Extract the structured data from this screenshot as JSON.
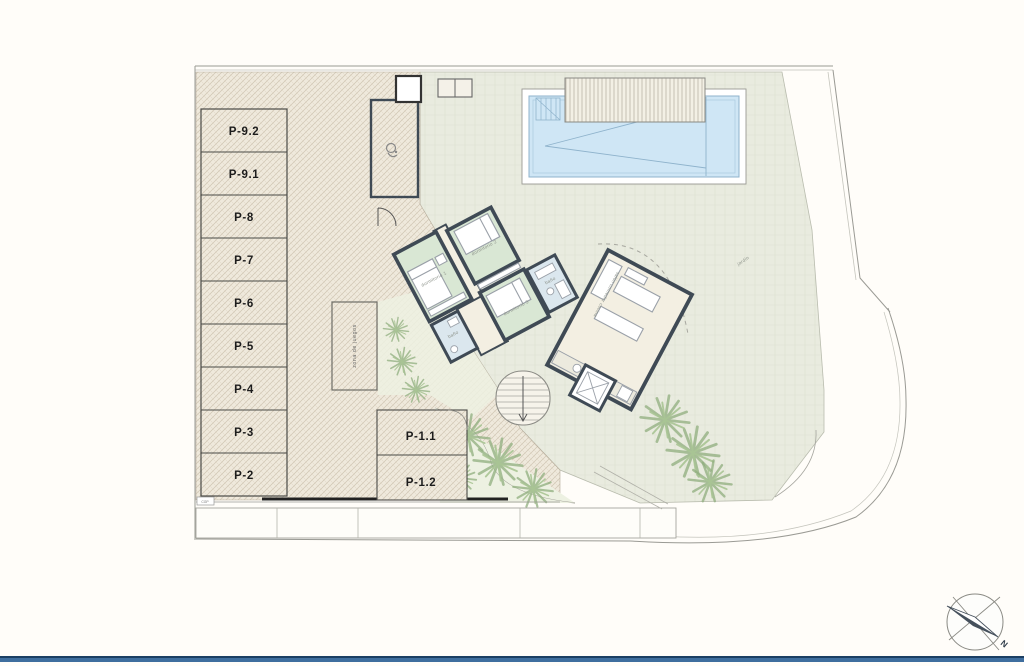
{
  "parking": {
    "stalls": [
      {
        "label": "P-9.2"
      },
      {
        "label": "P-9.1"
      },
      {
        "label": "P-8"
      },
      {
        "label": "P-7"
      },
      {
        "label": "P-6"
      },
      {
        "label": "P-5"
      },
      {
        "label": "P-4"
      },
      {
        "label": "P-3"
      },
      {
        "label": "P-2"
      }
    ],
    "front_stalls": [
      {
        "label": "P-1.1"
      },
      {
        "label": "P-1.2"
      }
    ]
  },
  "rooms": {
    "bedroom1": "dormitorio 1",
    "bedroom2": "dormitorio 2",
    "bedroom3": "dormitorio 3",
    "bath1": "baño",
    "bath2": "baño",
    "living": "salón comedor cocina"
  },
  "annotations": {
    "play_area": "zona de juegos",
    "utility_box": "CGP",
    "porch": "porche",
    "garden": "jardín"
  },
  "compass": {
    "north_label": "N"
  },
  "colors": {
    "pool_water": "#cfe6f5",
    "walls": "#3f4a55",
    "bedroom_fill": "#d9e7d4",
    "bath_fill": "#dbe7ee",
    "living_fill": "#f3efe2",
    "footer_bar": "#3f6e9e"
  }
}
